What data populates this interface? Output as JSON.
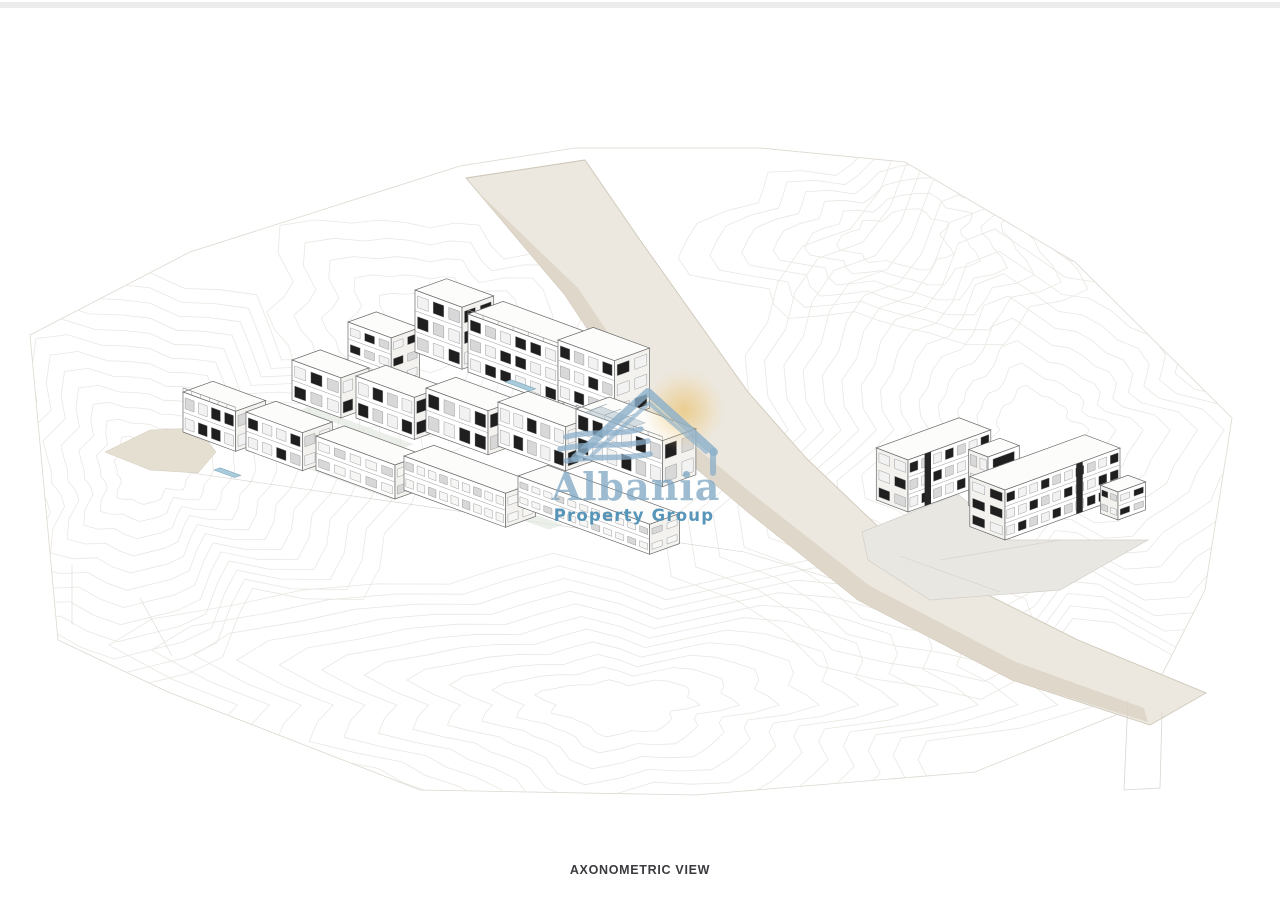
{
  "page": {
    "background": "#ffffff",
    "top_bar_color": "#ececec"
  },
  "caption": {
    "label": "AXONOMETRIC VIEW",
    "color": "#3b3b3f"
  },
  "watermark": {
    "brand": "Albania",
    "tagline": "Property Group",
    "logo_icon": "house-roof-icon",
    "sun_icon": "sun-glow-icon",
    "brand_color": "#79a3c0",
    "tagline_color": "#4f90b6",
    "logo_color": "#8bafc9",
    "sun_color": "#e8b54c"
  },
  "scene": {
    "type": "architectural-axonometric-site-plan",
    "elements": [
      "topographic-contours",
      "diagonal-road",
      "terraced-apartment-cluster",
      "l-shaped-building",
      "pools",
      "terraces",
      "plaza"
    ],
    "colors": {
      "line": "#6b6b6b",
      "face": "#ffffff",
      "side": "#f3f2ef",
      "roof": "#fcfcfb",
      "window": "#1f1f1f",
      "glass": "#d8d8d8",
      "pool": "#a9cbdb",
      "pool_edge": "#7fa7bc",
      "terrace": "#e4eae1",
      "road": "#ece8e0",
      "road_edge": "#cfc8ba",
      "road_band": "#ddd5c6",
      "plaza": "#e9e7e2",
      "plaza_edge": "#d2cfc8",
      "contour": "#e8e5df",
      "boundary": "#ddd8d0",
      "drive": "#e5dfd2",
      "deck": "#b9c9d3"
    }
  }
}
